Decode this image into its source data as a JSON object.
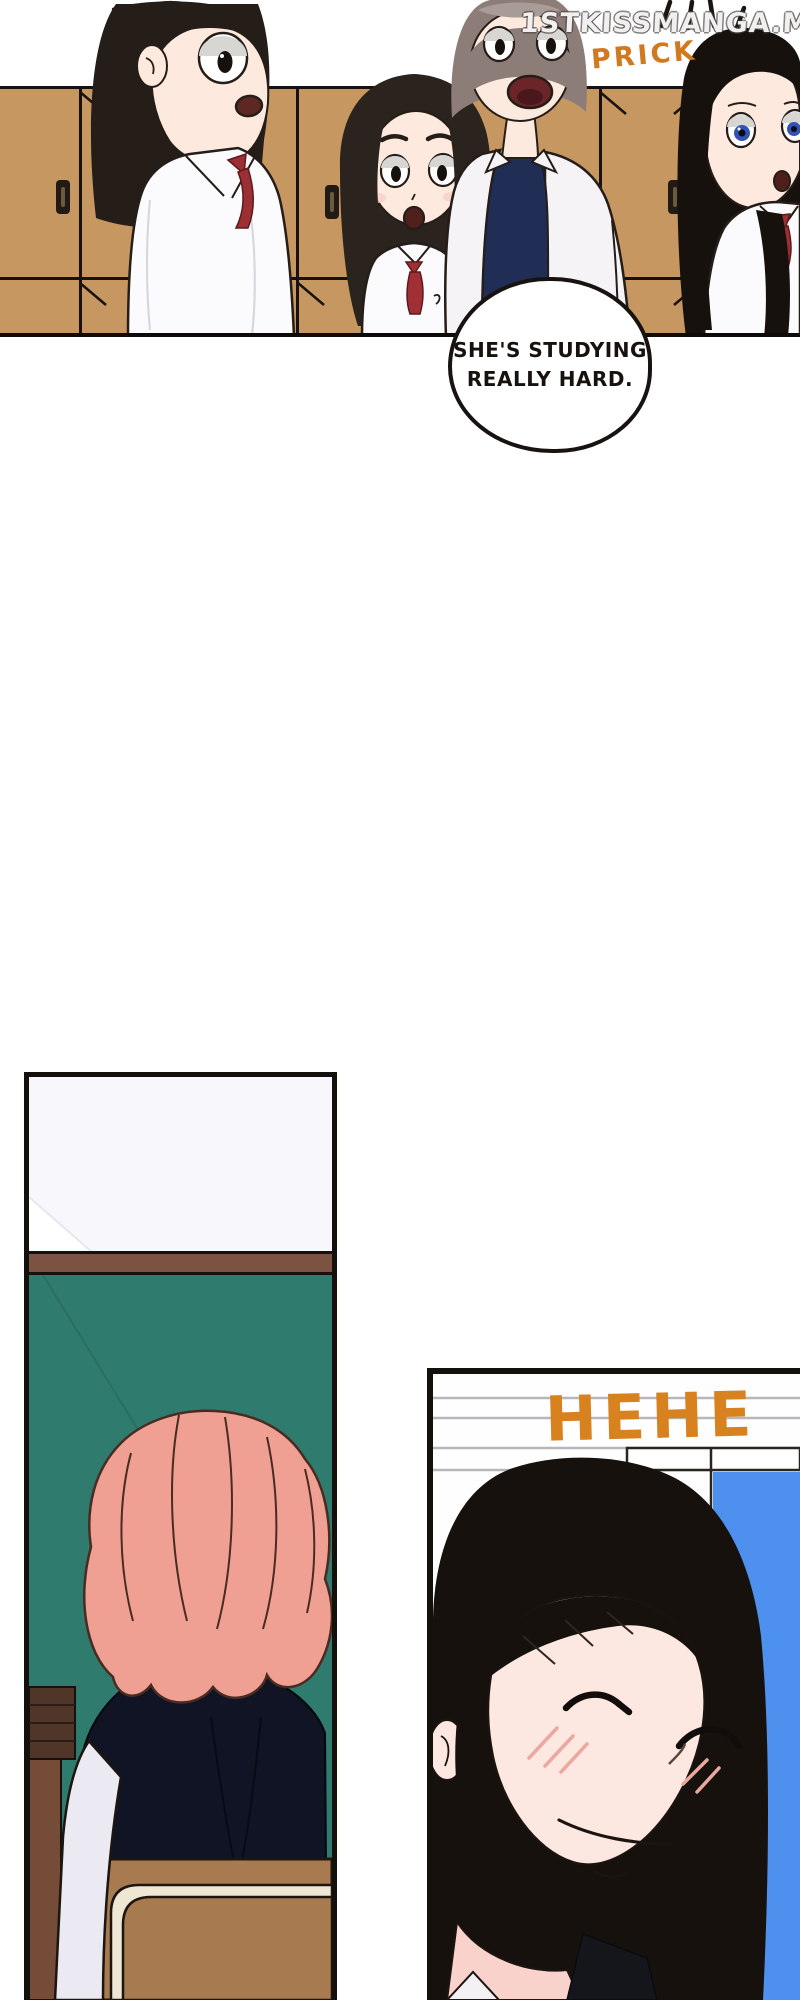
{
  "watermark": {
    "text": "1STKISSMANGA.ME"
  },
  "panels": {
    "classroom": {
      "description": "Four surprised students in school uniforms in front of tan lockers",
      "sfx": "PRICK",
      "speech_bubble": {
        "lines": [
          "SHE'S STUDYING",
          "REALLY HARD."
        ]
      }
    },
    "chalkboard": {
      "description": "Student with wavy pink hair seated at a chair facing a green chalkboard"
    },
    "smile": {
      "description": "Girl with long black hair smiling with closed eyes beside a window",
      "sfx": "HEHE"
    }
  },
  "colors": {
    "locker_tan": "#c69760",
    "chalkboard_green": "#2f7b6d",
    "rail_brown": "#7c5342",
    "podium_brown": "#744c37",
    "frame_dark_brown": "#503529",
    "hair_pink": "#efa093",
    "hair_black": "#17110e",
    "hair_gray_brown": "#8d7d78",
    "window_blue": "#4d90ee",
    "sfx_orange": "#d7821f",
    "ribbon_red": "#9c2f33",
    "navy_shirt": "#202e55",
    "chair_brown": "#a87a50",
    "chair_cream": "#efe6d4",
    "skin": "#fde9dd",
    "eye_blue": "#3352b4",
    "panel_border": "#14100c"
  }
}
